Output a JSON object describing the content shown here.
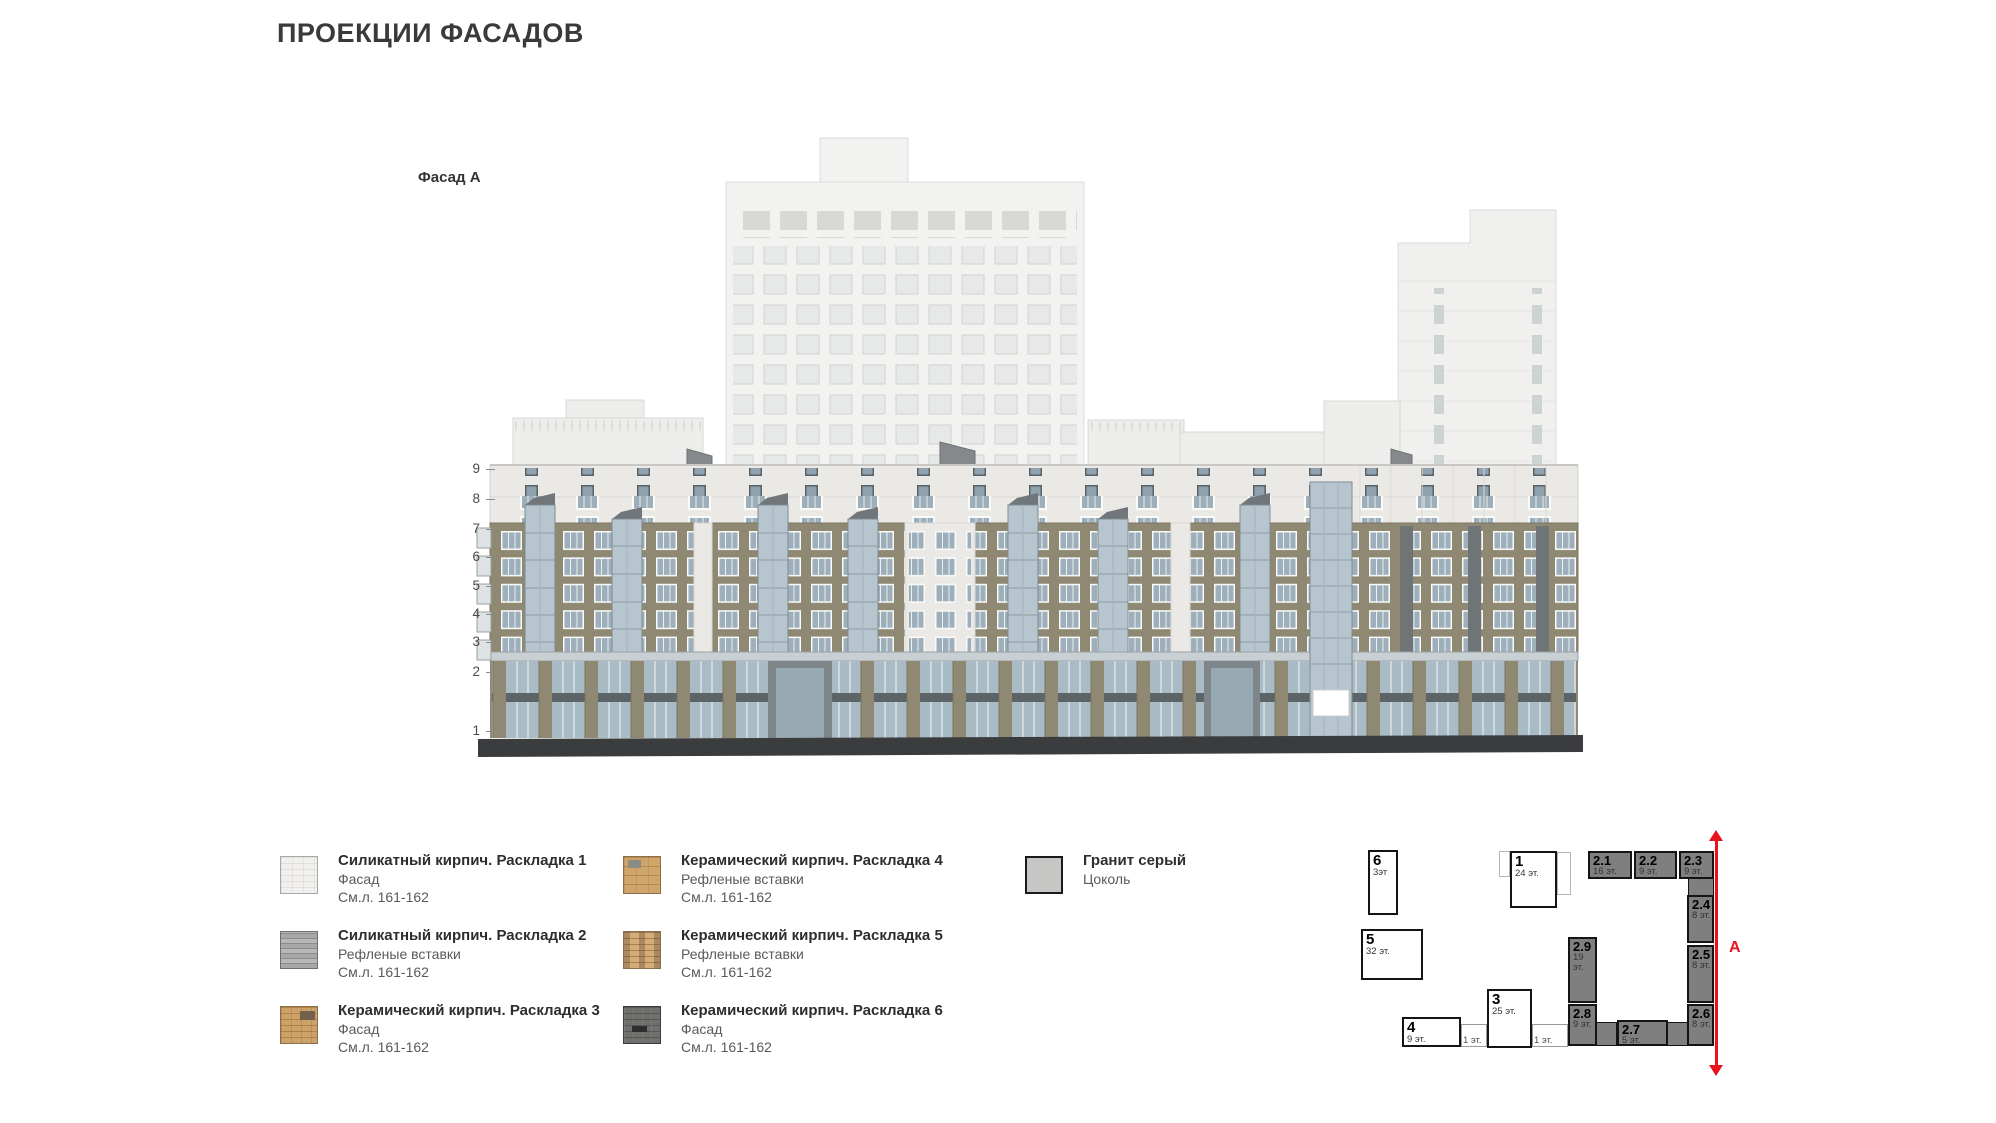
{
  "page": {
    "title": "ПРОЕКЦИИ ФАСАДОВ"
  },
  "elevation": {
    "label": "Фасад А",
    "floor_numbers": [
      "9",
      "8",
      "7",
      "6",
      "5",
      "4",
      "3",
      "2",
      "1"
    ]
  },
  "legend": {
    "items": [
      {
        "id": "silicate-1",
        "col": 1,
        "title": "Силикатный кирпич. Раскладка 1",
        "lines": [
          "Фасад",
          "См.л. 161-162"
        ]
      },
      {
        "id": "silicate-2",
        "col": 1,
        "title": "Силикатный кирпич. Раскладка 2",
        "lines": [
          "Рефленые вставки",
          "См.л. 161-162"
        ]
      },
      {
        "id": "ceramic-3",
        "col": 1,
        "title": "Керамический кирпич. Раскладка 3",
        "lines": [
          "Фасад",
          "См.л. 161-162"
        ]
      },
      {
        "id": "ceramic-4",
        "col": 2,
        "title": "Керамический кирпич. Раскладка 4",
        "lines": [
          "Рефленые вставки",
          "См.л. 161-162"
        ]
      },
      {
        "id": "ceramic-5",
        "col": 2,
        "title": "Керамический кирпич. Раскладка 5",
        "lines": [
          "Рефленые вставки",
          "См.л. 161-162"
        ]
      },
      {
        "id": "ceramic-6",
        "col": 2,
        "title": "Керамический кирпич. Раскладка 6",
        "lines": [
          "Фасад",
          "См.л. 161-162"
        ]
      },
      {
        "id": "granite",
        "col": 3,
        "title": "Гранит серый",
        "lines": [
          "Цоколь"
        ]
      }
    ]
  },
  "site_plan": {
    "section_label": "А",
    "buildings": [
      {
        "num": "6",
        "floors": "3эт",
        "style": "light",
        "x": 1368,
        "y": 850,
        "w": 30,
        "h": 65
      },
      {
        "num": "5",
        "floors": "32 эт.",
        "style": "light",
        "x": 1361,
        "y": 929,
        "w": 62,
        "h": 51
      },
      {
        "num": "1",
        "floors": "24 эт.",
        "style": "light",
        "x": 1510,
        "y": 851,
        "w": 47,
        "h": 57
      },
      {
        "num": "4",
        "floors": "9 эт.",
        "style": "light",
        "x": 1402,
        "y": 1017,
        "w": 59,
        "h": 30
      },
      {
        "num": "3",
        "floors": "25 эт.",
        "style": "light",
        "x": 1487,
        "y": 989,
        "w": 45,
        "h": 59
      },
      {
        "num": "2.1",
        "floors": "16 эт.",
        "style": "dark",
        "x": 1588,
        "y": 851,
        "w": 44,
        "h": 28
      },
      {
        "num": "2.2",
        "floors": "9 эт.",
        "style": "dark",
        "x": 1634,
        "y": 851,
        "w": 43,
        "h": 28
      },
      {
        "num": "2.3",
        "floors": "9 эт.",
        "style": "dark",
        "x": 1679,
        "y": 851,
        "w": 35,
        "h": 28
      },
      {
        "num": "2.4",
        "floors": "8 эт.",
        "style": "dark",
        "x": 1687,
        "y": 895,
        "w": 27,
        "h": 48
      },
      {
        "num": "2.5",
        "floors": "8 эт.",
        "style": "dark",
        "x": 1687,
        "y": 945,
        "w": 27,
        "h": 58
      },
      {
        "num": "2.6",
        "floors": "8 эт.",
        "style": "dark",
        "x": 1687,
        "y": 1004,
        "w": 27,
        "h": 42
      },
      {
        "num": "2.7",
        "floors": "5 эт.",
        "style": "dark",
        "x": 1617,
        "y": 1020,
        "w": 51,
        "h": 26
      },
      {
        "num": "2.8",
        "floors": "9 эт.",
        "style": "dark",
        "x": 1568,
        "y": 1004,
        "w": 29,
        "h": 42
      },
      {
        "num": "2.9",
        "floors": "19 эт.",
        "style": "dark",
        "x": 1568,
        "y": 937,
        "w": 29,
        "h": 66
      }
    ],
    "connectors": [
      {
        "label": "1 эт.",
        "x": 1461,
        "y": 1024,
        "w": 26,
        "h": 23
      },
      {
        "label": "1 эт.",
        "x": 1532,
        "y": 1024,
        "w": 36,
        "h": 23
      }
    ],
    "links": [
      {
        "x": 1595,
        "y": 1022,
        "w": 22,
        "h": 24
      },
      {
        "x": 1666,
        "y": 1022,
        "w": 23,
        "h": 24
      },
      {
        "x": 1688,
        "y": 877,
        "w": 26,
        "h": 20
      }
    ],
    "wings": [
      {
        "x": 1499,
        "y": 851,
        "w": 11,
        "h": 26
      },
      {
        "x": 1557,
        "y": 852,
        "w": 14,
        "h": 43
      }
    ]
  },
  "colors": {
    "accent_red": "#e8131c",
    "brick_tan": "#8f8872",
    "glass_blue": "#b7c5ce",
    "plinth_dark": "#3a3c3d",
    "plan_dark_fill": "#7f7f7f",
    "background_building": "#f2f2f0"
  }
}
